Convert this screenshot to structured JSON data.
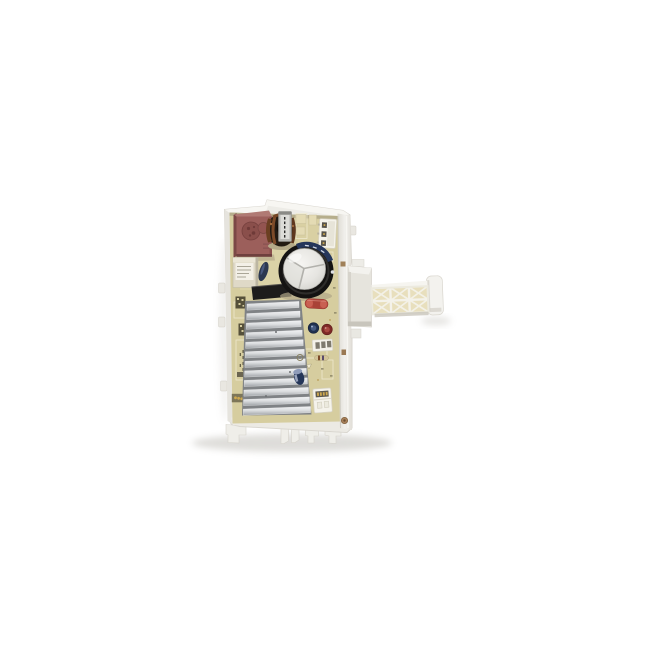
{
  "image": {
    "alt": "Product photo of a washing machine inverter control board: a cream PCB mounted in a white plastic frame with a red film capacitor, black electrolytic capacitor, aluminum heatsink and a latticed white mounting arm extending to the right, on a plain white background",
    "background": "#ffffff"
  },
  "palette": {
    "frame_plastic": "#edece7",
    "frame_bright": "#f7f6f2",
    "frame_shadow": "#d5d2ca",
    "pcb": "#d6cd9f",
    "pcb_dark": "#b6ae8c",
    "silkscreen": "#f0ebd2",
    "heatsink_base": "#7f8285",
    "heatsink_bright": "#f1f2f4",
    "heatsink_dark": "#9fa3a7",
    "capacitor_body": "#141312",
    "capacitor_sleeve": "#25365b",
    "capacitor_top": "#e9e8e4",
    "film_cap_red": "#9c5f5b",
    "film_cap_red_top": "#b07a74",
    "relay_cream": "#dfd9c7",
    "resistor_red": "#b8493e",
    "cap_blue": "#20304f",
    "cap_red_small": "#7e2926",
    "connector_white": "#f5f3eb",
    "pin_gold": "#cfa94f",
    "toroid_dark": "#221a12",
    "copper": "#7c4a28",
    "arm_cell": "#e8dfbd",
    "arm_rib": "#f4f2ea",
    "qr_dark": "#55503a"
  },
  "parts": {
    "frame": "white plastic mounting frame",
    "arm": "latticed mounting arm",
    "emi_capacitor": "red film capacitor",
    "relay": "relay with label",
    "inductor": "toroidal inductor",
    "electrolytic": "electrolytic capacitor, silver vented top",
    "heatsink": "finned aluminum heatsink",
    "connectors": "white header connectors",
    "qr": "printed QR codes"
  },
  "counts": {
    "heatsink_fins": 12,
    "lattice_rows": 2,
    "lattice_cols": 3,
    "top_connector_pins": 3,
    "bottom_connector_pins": 4
  }
}
